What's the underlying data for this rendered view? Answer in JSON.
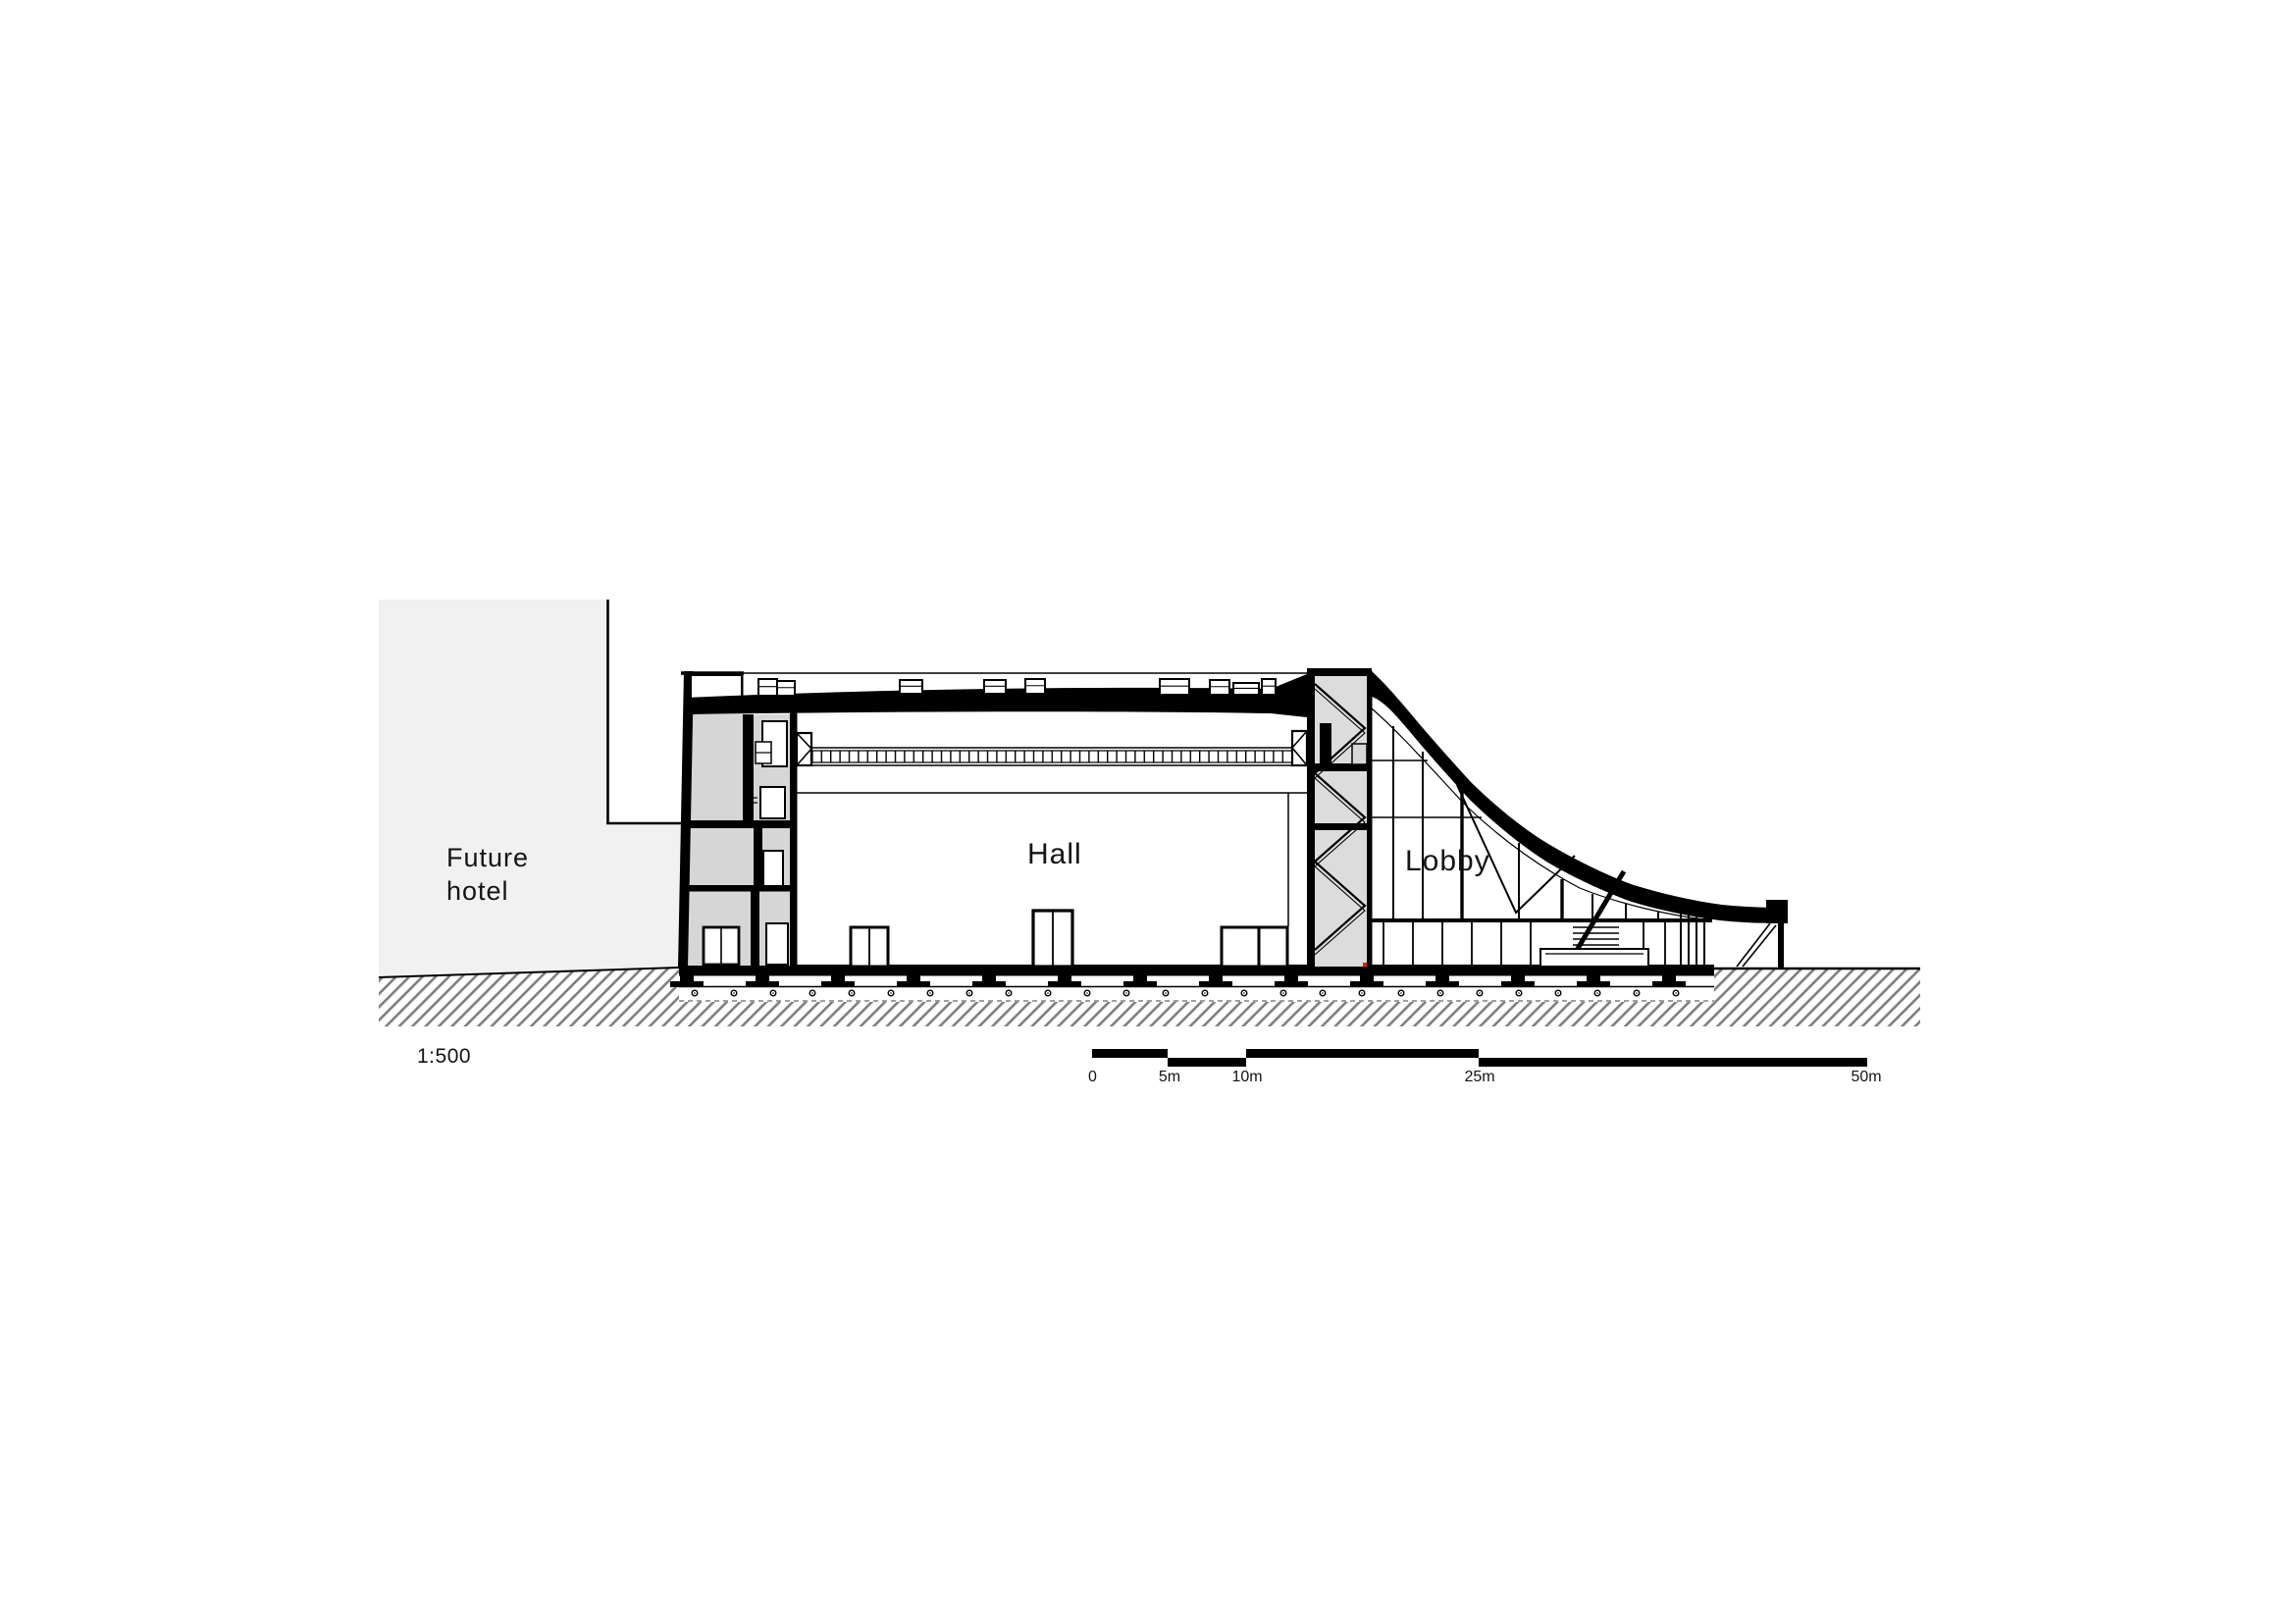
{
  "drawing": {
    "type": "architectural-section",
    "labels": {
      "future_hotel_line1": "Future",
      "future_hotel_line2": "hotel",
      "hall": "Hall",
      "lobby": "Lobby"
    },
    "scale": {
      "ratio": "1:500",
      "ticks": [
        "0",
        "5m",
        "10m",
        "25m",
        "50m"
      ]
    },
    "colors": {
      "ink": "#000000",
      "paper": "#ffffff",
      "site-gray": "#f1f1f1",
      "room-gray": "#d6d6d6",
      "panel-gray": "#dcdcdc",
      "hatch-gray": "#7f7f7f",
      "accent-red": "#c22a21"
    }
  }
}
